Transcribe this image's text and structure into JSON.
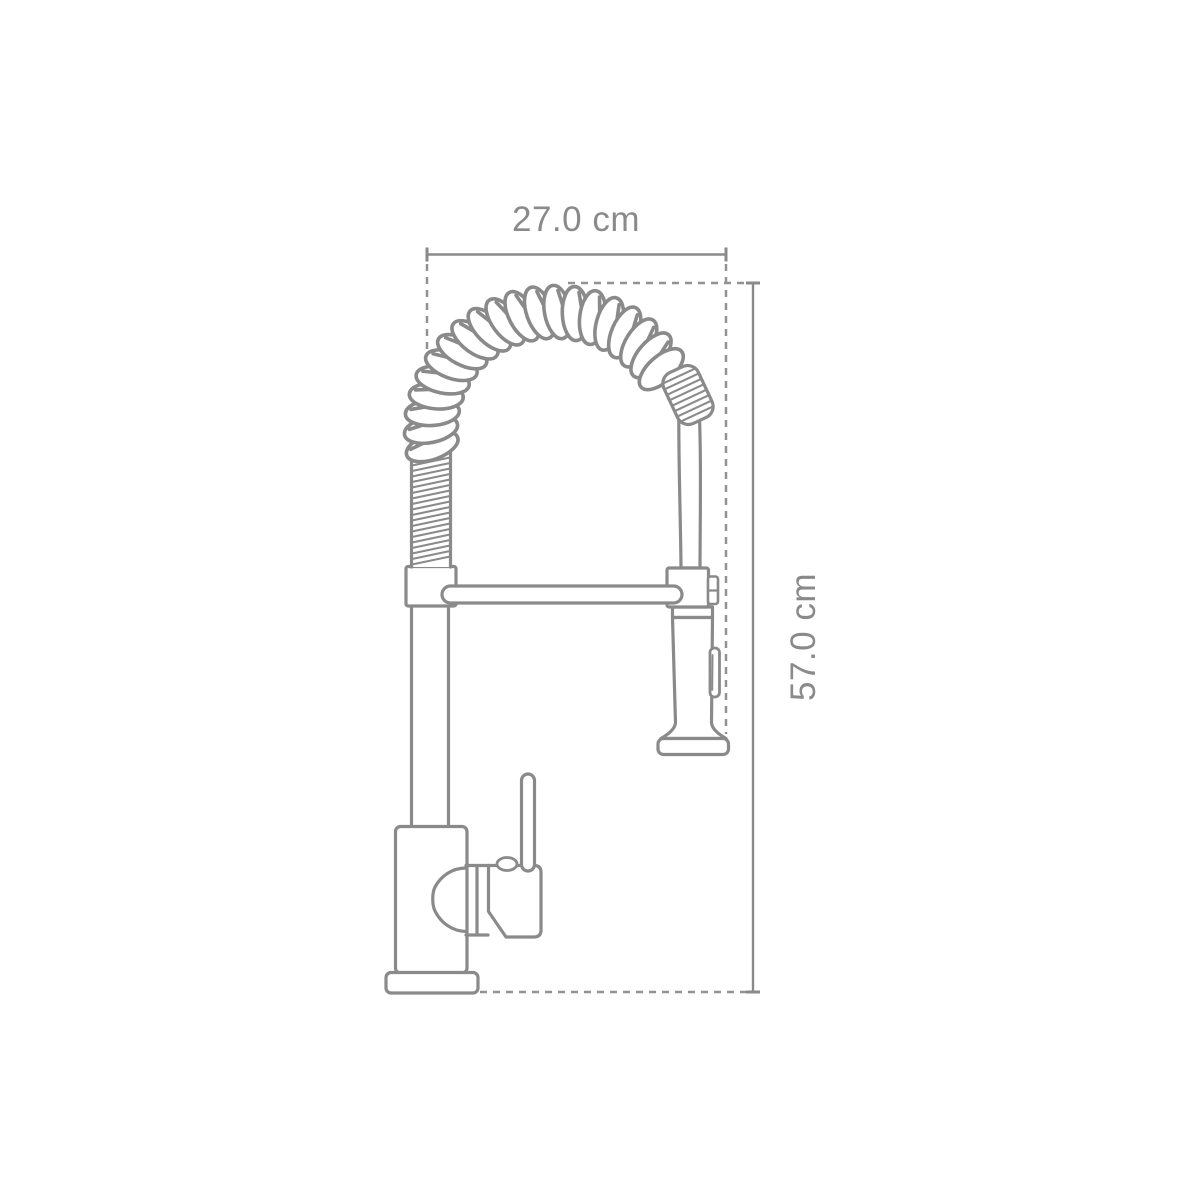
{
  "diagram": {
    "subject": "pull-down-spring-kitchen-faucet",
    "background": "#ffffff",
    "line_color": "#8a8a8a",
    "dash_color": "#929292",
    "text_color": "#8a8a8a",
    "dimensions": {
      "width": {
        "label": "27.0 cm",
        "orientation": "horizontal"
      },
      "height": {
        "label": "57.0 cm",
        "orientation": "vertical"
      }
    }
  }
}
